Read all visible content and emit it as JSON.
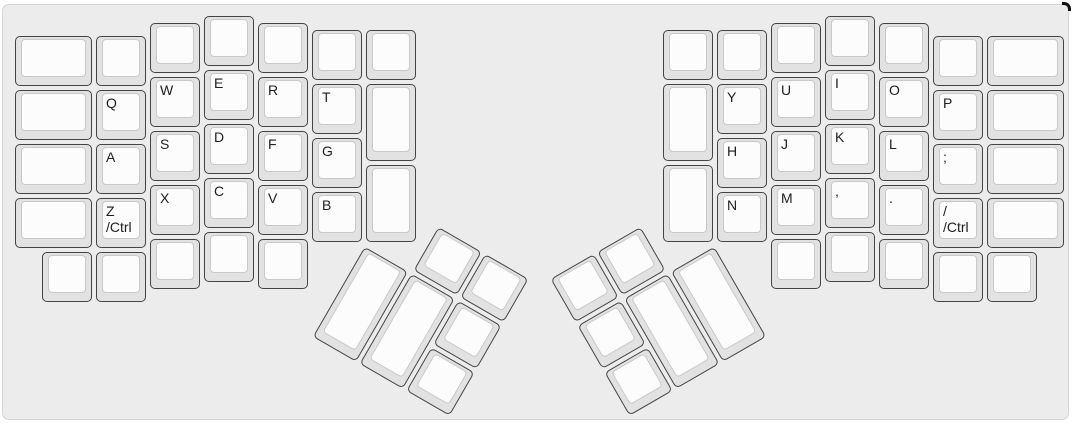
{
  "title": "split-ergonomic-keyboard-layout",
  "colors": {
    "page_bg": "#ffffff",
    "board_bg": "#ececec",
    "board_border": "#d4d4d4",
    "key_base": "#e2e2e2",
    "key_border": "#444444",
    "key_top": "#fcfcfc",
    "key_top_border": "#c9c9c9",
    "label": "#1e1e1e",
    "corner_mark": "#111111"
  },
  "layout": {
    "unit": 54,
    "origin_x": 10,
    "origin_y": 9,
    "key_inset": 2
  },
  "left_main_keys": [
    {
      "x": 0,
      "y": 0.375,
      "w": 1.5,
      "label": ""
    },
    {
      "x": 0,
      "y": 1.375,
      "w": 1.5,
      "label": ""
    },
    {
      "x": 0,
      "y": 2.375,
      "w": 1.5,
      "label": ""
    },
    {
      "x": 0,
      "y": 3.375,
      "w": 1.5,
      "label": ""
    },
    {
      "x": 1.5,
      "y": 0.375,
      "label": ""
    },
    {
      "x": 1.5,
      "y": 1.375,
      "label": "Q",
      "n": "key-q"
    },
    {
      "x": 1.5,
      "y": 2.375,
      "label": "A",
      "n": "key-a"
    },
    {
      "x": 1.5,
      "y": 3.375,
      "label": "Z\n/Ctrl",
      "n": "key-z-ctrl"
    },
    {
      "x": 2.5,
      "y": 0.125,
      "label": ""
    },
    {
      "x": 2.5,
      "y": 1.125,
      "label": "W",
      "n": "key-w"
    },
    {
      "x": 2.5,
      "y": 2.125,
      "label": "S",
      "n": "key-s"
    },
    {
      "x": 2.5,
      "y": 3.125,
      "label": "X",
      "n": "key-x"
    },
    {
      "x": 3.5,
      "y": 0,
      "label": ""
    },
    {
      "x": 3.5,
      "y": 1,
      "label": "E",
      "n": "key-e"
    },
    {
      "x": 3.5,
      "y": 2,
      "label": "D",
      "n": "key-d"
    },
    {
      "x": 3.5,
      "y": 3,
      "label": "C",
      "n": "key-c"
    },
    {
      "x": 4.5,
      "y": 0.125,
      "label": ""
    },
    {
      "x": 4.5,
      "y": 1.125,
      "label": "R",
      "n": "key-r"
    },
    {
      "x": 4.5,
      "y": 2.125,
      "label": "F",
      "n": "key-f"
    },
    {
      "x": 4.5,
      "y": 3.125,
      "label": "V",
      "n": "key-v"
    },
    {
      "x": 5.5,
      "y": 0.25,
      "label": ""
    },
    {
      "x": 5.5,
      "y": 1.25,
      "label": "T",
      "n": "key-t"
    },
    {
      "x": 5.5,
      "y": 2.25,
      "label": "G",
      "n": "key-g"
    },
    {
      "x": 5.5,
      "y": 3.25,
      "label": "B",
      "n": "key-b"
    },
    {
      "x": 6.5,
      "y": 0.25,
      "label": ""
    },
    {
      "x": 6.5,
      "y": 1.25,
      "h": 1.5,
      "label": ""
    },
    {
      "x": 6.5,
      "y": 2.75,
      "h": 1.5,
      "label": ""
    },
    {
      "x": 0.5,
      "y": 4.375,
      "label": ""
    },
    {
      "x": 1.5,
      "y": 4.375,
      "label": ""
    },
    {
      "x": 2.5,
      "y": 4.125,
      "label": ""
    },
    {
      "x": 3.5,
      "y": 4,
      "label": ""
    },
    {
      "x": 4.5,
      "y": 4.125,
      "label": ""
    }
  ],
  "right_main_keys": [
    {
      "x": 12,
      "y": 0.25,
      "label": ""
    },
    {
      "x": 12,
      "y": 1.25,
      "h": 1.5,
      "label": ""
    },
    {
      "x": 12,
      "y": 2.75,
      "h": 1.5,
      "label": ""
    },
    {
      "x": 13,
      "y": 0.25,
      "label": ""
    },
    {
      "x": 13,
      "y": 1.25,
      "label": "Y",
      "n": "key-y"
    },
    {
      "x": 13,
      "y": 2.25,
      "label": "H",
      "n": "key-h"
    },
    {
      "x": 13,
      "y": 3.25,
      "label": "N",
      "n": "key-n"
    },
    {
      "x": 14,
      "y": 0.125,
      "label": ""
    },
    {
      "x": 14,
      "y": 1.125,
      "label": "U",
      "n": "key-u"
    },
    {
      "x": 14,
      "y": 2.125,
      "label": "J",
      "n": "key-j"
    },
    {
      "x": 14,
      "y": 3.125,
      "label": "M",
      "n": "key-m"
    },
    {
      "x": 15,
      "y": 0,
      "label": ""
    },
    {
      "x": 15,
      "y": 1,
      "label": "I",
      "n": "key-i"
    },
    {
      "x": 15,
      "y": 2,
      "label": "K",
      "n": "key-k"
    },
    {
      "x": 15,
      "y": 3,
      "label": ",",
      "n": "key-comma"
    },
    {
      "x": 16,
      "y": 0.125,
      "label": ""
    },
    {
      "x": 16,
      "y": 1.125,
      "label": "O",
      "n": "key-o"
    },
    {
      "x": 16,
      "y": 2.125,
      "label": "L",
      "n": "key-l"
    },
    {
      "x": 16,
      "y": 3.125,
      "label": ".",
      "n": "key-period"
    },
    {
      "x": 17,
      "y": 0.375,
      "label": ""
    },
    {
      "x": 17,
      "y": 1.375,
      "label": "P",
      "n": "key-p"
    },
    {
      "x": 17,
      "y": 2.375,
      "label": ";",
      "n": "key-semicolon"
    },
    {
      "x": 17,
      "y": 3.375,
      "label": "/\n/Ctrl",
      "n": "key-slash-ctrl"
    },
    {
      "x": 18,
      "y": 0.375,
      "w": 1.5,
      "label": ""
    },
    {
      "x": 18,
      "y": 1.375,
      "w": 1.5,
      "label": ""
    },
    {
      "x": 18,
      "y": 2.375,
      "w": 1.5,
      "label": ""
    },
    {
      "x": 18,
      "y": 3.375,
      "w": 1.5,
      "label": ""
    },
    {
      "x": 14,
      "y": 4.125,
      "label": ""
    },
    {
      "x": 15,
      "y": 4,
      "label": ""
    },
    {
      "x": 16,
      "y": 4.125,
      "label": ""
    },
    {
      "x": 17,
      "y": 4.375,
      "label": ""
    },
    {
      "x": 18,
      "y": 4.375,
      "label": ""
    }
  ],
  "left_thumb": {
    "rotation_deg": 30,
    "origin_x_units": 6.5,
    "origin_y_units": 4.25,
    "keys": [
      {
        "x": 1,
        "y": -1,
        "label": ""
      },
      {
        "x": 2,
        "y": -1,
        "label": ""
      },
      {
        "x": 0,
        "y": 0,
        "h": 2,
        "label": ""
      },
      {
        "x": 1,
        "y": 0,
        "h": 2,
        "label": ""
      },
      {
        "x": 2,
        "y": 0,
        "label": ""
      },
      {
        "x": 2,
        "y": 1,
        "label": ""
      }
    ]
  },
  "right_thumb": {
    "rotation_deg": -30,
    "origin_x_units": 13,
    "origin_y_units": 4.25,
    "keys": [
      {
        "x": -2,
        "y": -1,
        "label": ""
      },
      {
        "x": -3,
        "y": -1,
        "label": ""
      },
      {
        "x": -1,
        "y": 0,
        "h": 2,
        "label": ""
      },
      {
        "x": -2,
        "y": 0,
        "h": 2,
        "label": ""
      },
      {
        "x": -3,
        "y": 0,
        "label": ""
      },
      {
        "x": -3,
        "y": 1,
        "label": ""
      }
    ]
  }
}
